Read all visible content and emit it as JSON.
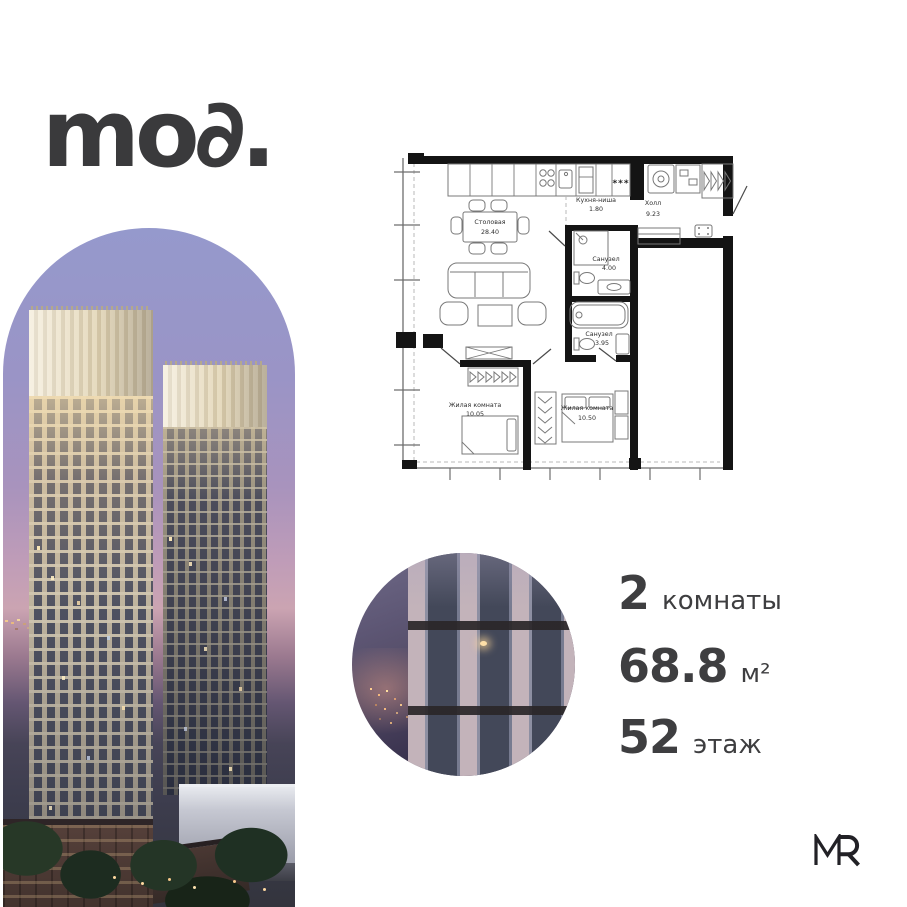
{
  "brand": {
    "logo_text": "mo∂."
  },
  "developer": {
    "logo_text": "MR"
  },
  "plan": {
    "freezer_marks": "***",
    "rooms": {
      "dining": {
        "name": "Столовая",
        "area": "28.40"
      },
      "kitchen": {
        "name": "Кухня-ниша",
        "area": "1.80"
      },
      "hall": {
        "name": "Холл",
        "area": "9.23"
      },
      "bath1": {
        "name": "Санузел",
        "area": "4.00"
      },
      "bath2": {
        "name": "Санузел",
        "area": "3.95"
      },
      "bedroom1": {
        "name": "Жилая комната",
        "area": "10.05"
      },
      "bedroom2": {
        "name": "Жилая комната",
        "area": "10.50"
      }
    }
  },
  "specs": {
    "rooms": {
      "value": "2",
      "label": "комнаты"
    },
    "area": {
      "value": "68.8",
      "label": "м²"
    },
    "floor": {
      "value": "52",
      "label": "этаж"
    }
  },
  "colors": {
    "text": "#3e3e40",
    "plan_walls": "#141414",
    "sky_top": "#9599cc",
    "sky_pink": "#cba4b2"
  }
}
